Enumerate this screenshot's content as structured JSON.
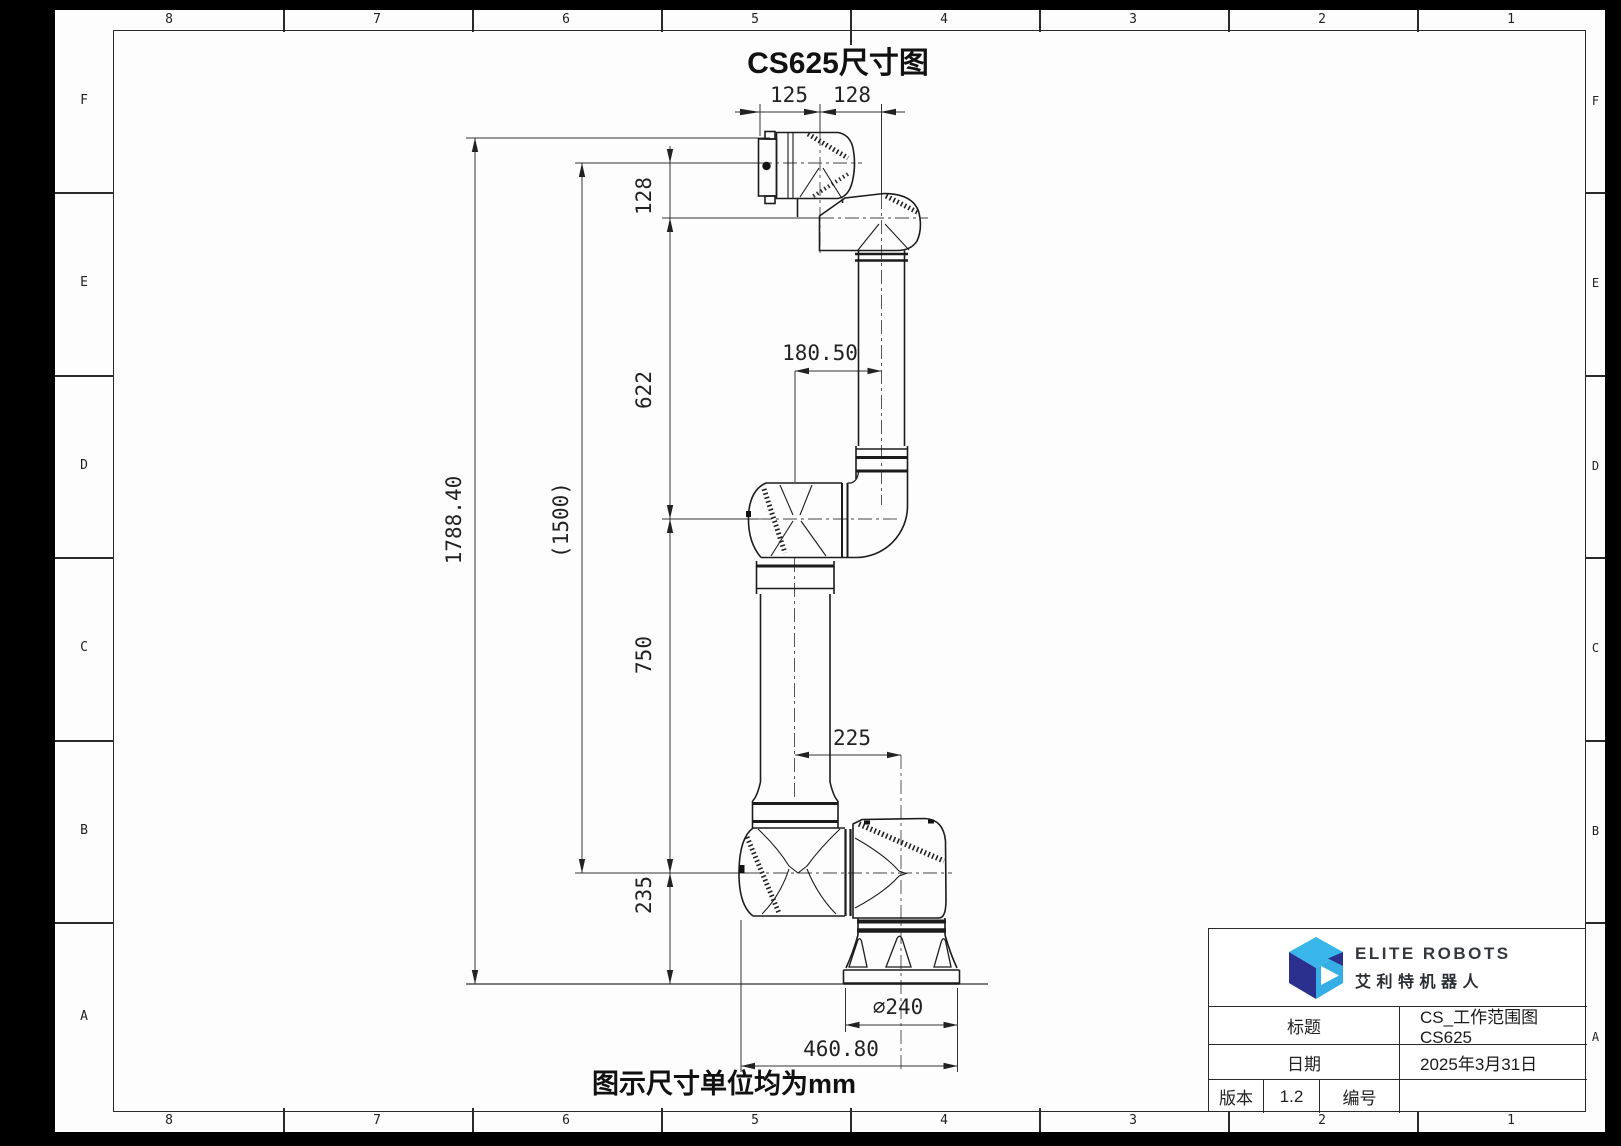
{
  "sheet": {
    "title": "CS625尺寸图",
    "note": "图示尺寸单位均为mm",
    "grid_columns": [
      "8",
      "7",
      "6",
      "5",
      "4",
      "3",
      "2",
      "1"
    ],
    "grid_rows": [
      "F",
      "E",
      "D",
      "C",
      "B",
      "A"
    ]
  },
  "dimensions": {
    "flange_offset": "125",
    "wrist_offset": "128",
    "wrist_height": "128",
    "upper_arm": "622",
    "lower_arm": "750",
    "base_height": "235",
    "overall_height": "1788.40",
    "working_height": "(1500)",
    "elbow_offset": "180.50",
    "shoulder_offset": "225",
    "base_diameter": "∅240",
    "overall_width": "460.80"
  },
  "title_block": {
    "brand_en": "ELITE ROBOTS",
    "brand_cn": "艾利特机器人",
    "logo_colors": {
      "top": "#38b6ea",
      "left": "#2b2f8e",
      "right": "#35aee6",
      "wedge": "#2b2f8e"
    },
    "title_label": "标题",
    "title_value": "CS_工作范围图 CS625",
    "date_label": "日期",
    "date_value": "2025年3月31日",
    "version_label": "版本",
    "version_value": "1.2",
    "number_label": "编号",
    "number_value": ""
  }
}
